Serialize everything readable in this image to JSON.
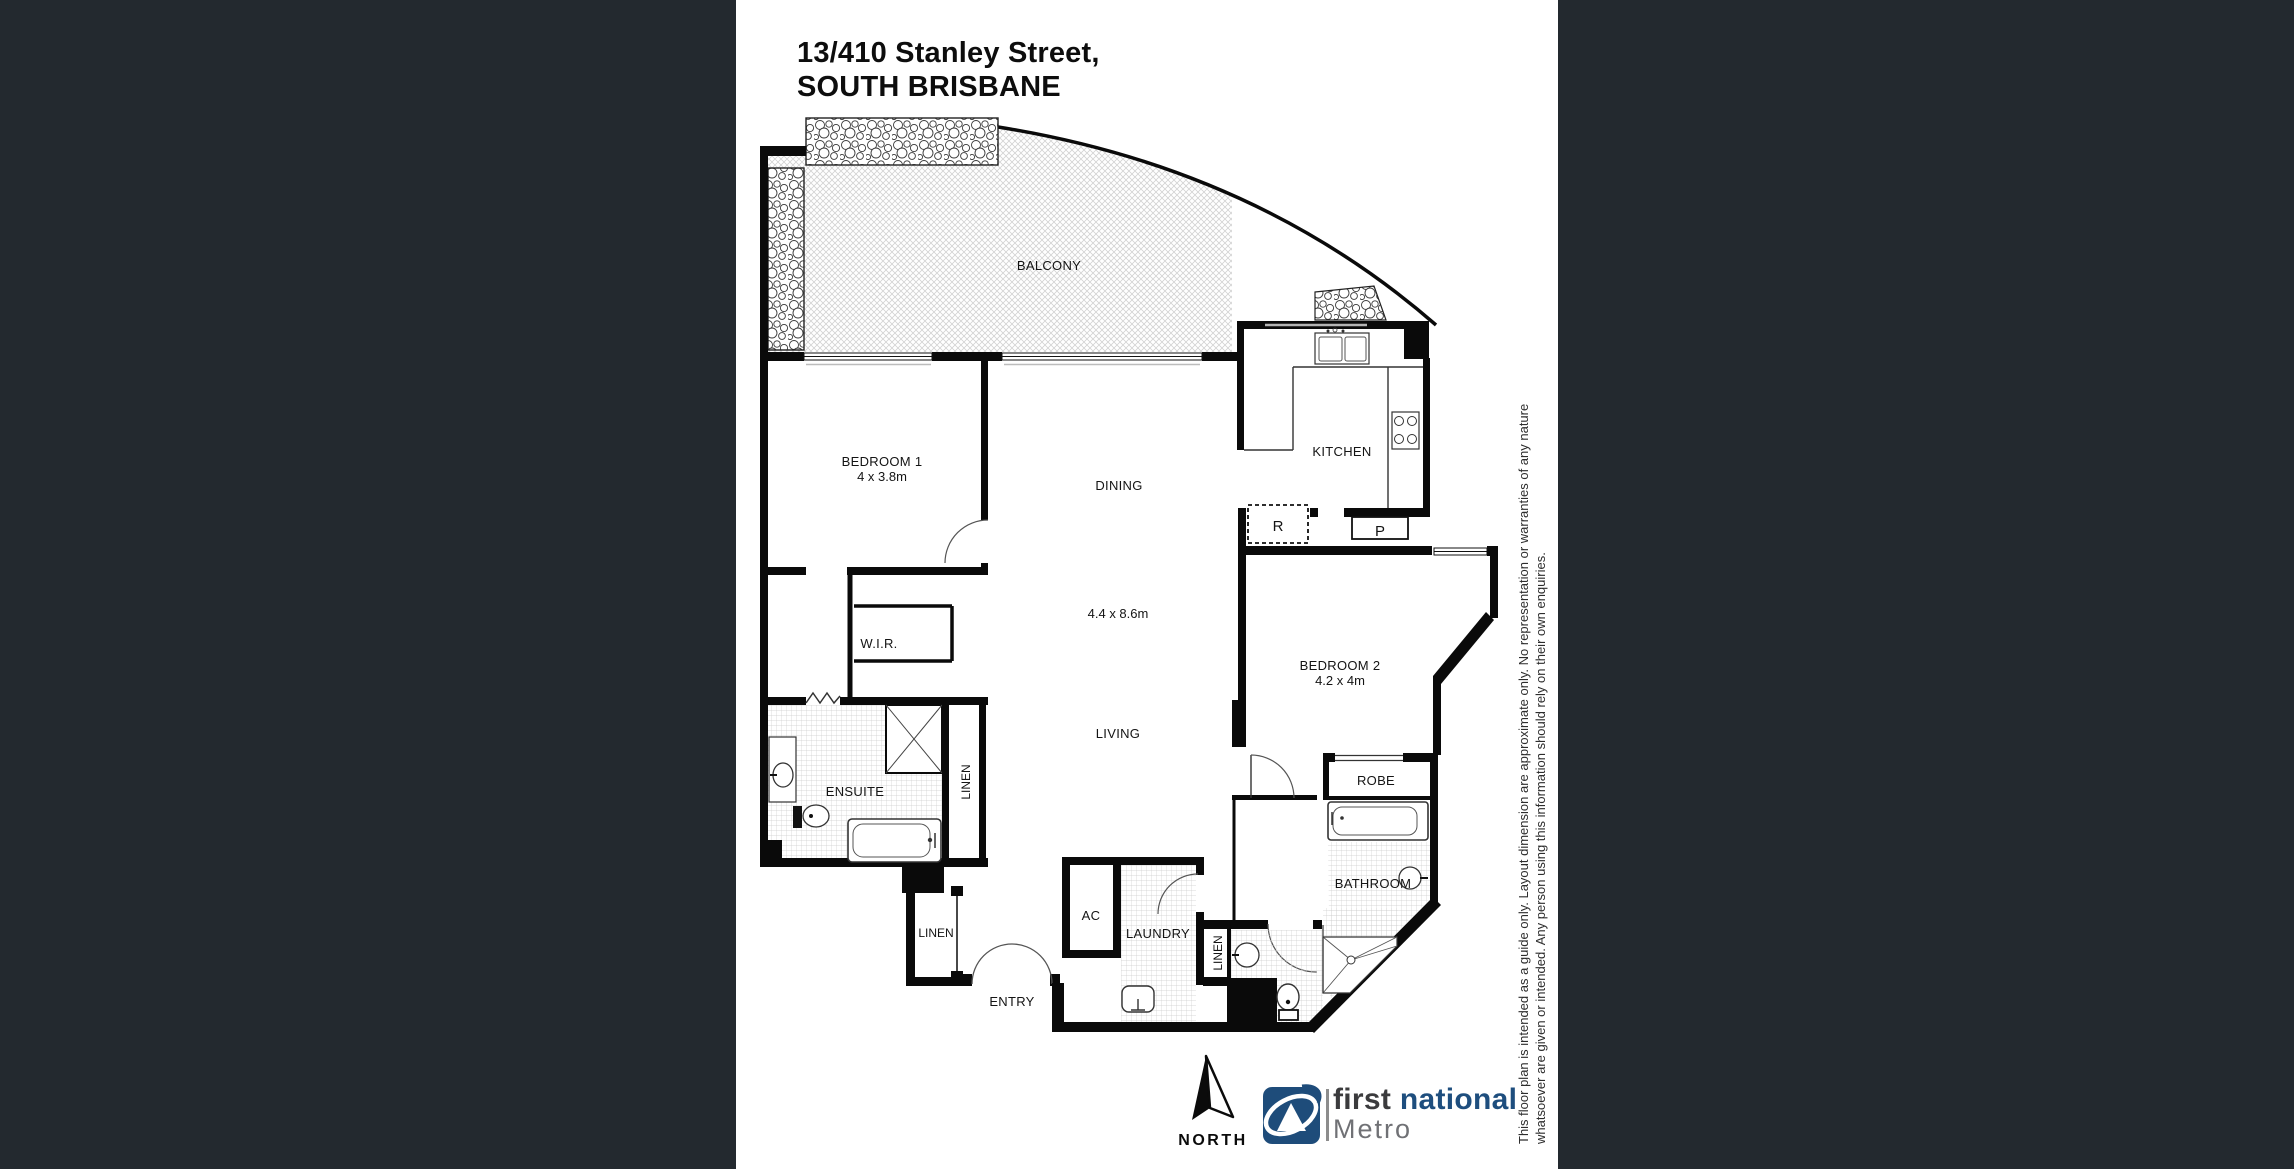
{
  "title": {
    "line1": "13/410 Stanley Street,",
    "line2": "SOUTH BRISBANE"
  },
  "floorplan": {
    "labels": {
      "balcony": "BALCONY",
      "bedroom1": "BEDROOM 1",
      "bedroom1_dims": "4 x 3.8m",
      "dining": "DINING",
      "living_dims": "4.4 x 8.6m",
      "living": "LIVING",
      "kitchen": "KITCHEN",
      "wir": "W.I.R.",
      "fridge": "R",
      "pantry": "P",
      "bedroom2": "BEDROOM 2",
      "bedroom2_dims": "4.2 x 4m",
      "robe": "ROBE",
      "bathroom": "BATHROOM",
      "ensuite": "ENSUITE",
      "linen_ensuite": "LINEN",
      "linen_hall": "LINEN",
      "linen_bath": "LINEN",
      "laundry": "LAUNDRY",
      "ac": "AC",
      "entry": "ENTRY"
    }
  },
  "compass": {
    "label": "NORTH"
  },
  "brand": {
    "word1": "first",
    "word2": "national",
    "sub": "Metro",
    "blue": "#1e4e7e",
    "dark_gray": "#3b3b3d",
    "metro_gray": "#707175"
  },
  "disclaimer": {
    "line1": "This floor plan is intended as a guide only. Layout dimension are approximate only. No representation or warranties of any nature",
    "line2": "whatsoever are given or intended. Any person using this information should rely on their own enquiries."
  },
  "colors": {
    "background": "#23292f",
    "panel": "#ffffff",
    "walls": "#0a0a0a"
  }
}
